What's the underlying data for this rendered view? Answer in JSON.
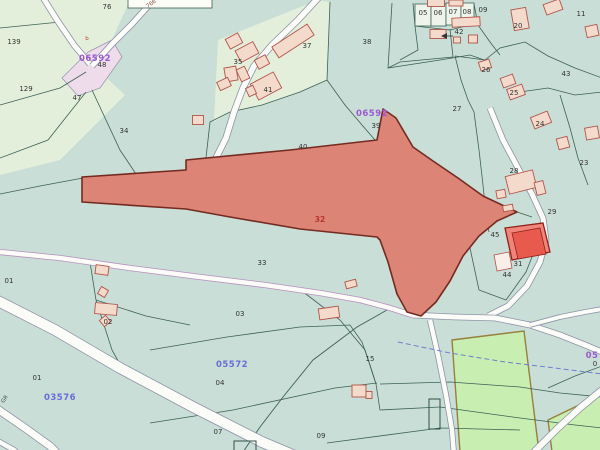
{
  "map_label": "cadastral-parcel-map",
  "colors": {
    "bg": "#c9ded6",
    "light": "#e4efdb",
    "line": "#3c6156",
    "road_fill": "#fbfbf7",
    "road_casing": "#8e93a8",
    "road_casing_purple": "#b88fc0",
    "junction_fill": "#eedceb",
    "field_fill": "#c9eeb2",
    "field_stroke": "#97803d",
    "p32_fill": "#dc8577",
    "p32_stroke": "#752a21",
    "p32_label": "#b5342c",
    "p31_fill": "#f0857b",
    "p31_stroke": "#8f2018",
    "p31_bld": "#e85a4e",
    "bld_fill": "#f4dacb",
    "bld_stroke": "#b2544a",
    "white_bld_fill": "#f8efe9",
    "stream": "#6f7fd0",
    "box_fill": "#eef4ec",
    "white_parcel_fill": "#fdfdf8",
    "sheet_purple": "#9b59d0",
    "sheet_blue": "#6b6bd8"
  },
  "light_areas": [
    [
      0,
      0,
      130,
      0,
      98,
      70,
      125,
      95,
      60,
      160,
      0,
      175
    ],
    [
      218,
      40,
      318,
      0,
      330,
      2,
      327,
      80,
      300,
      92,
      262,
      105,
      230,
      112,
      214,
      122
    ]
  ],
  "junction": [
    62,
    78,
    88,
    52,
    112,
    40,
    122,
    57,
    100,
    88,
    78,
    96
  ],
  "fields": [
    [
      452,
      340,
      524,
      331,
      539,
      452,
      460,
      452
    ],
    [
      548,
      420,
      602,
      394,
      602,
      452,
      552,
      452
    ]
  ],
  "white_parcel": [
    128,
    -5,
    84,
    13
  ],
  "boxes": [
    [
      415,
      4,
      16,
      22
    ],
    [
      431,
      4,
      15,
      22
    ],
    [
      446,
      3,
      15,
      22
    ],
    [
      461,
      3,
      13,
      22
    ]
  ],
  "dark_rects": [
    [
      429,
      399,
      11,
      30
    ],
    [
      234,
      441,
      22,
      12
    ]
  ],
  "boundaries": [
    [
      0,
      28,
      60,
      22,
      86,
      60
    ],
    [
      0,
      105,
      60,
      88,
      86,
      72
    ],
    [
      0,
      158,
      48,
      140,
      86,
      92
    ],
    [
      92,
      90,
      120,
      150,
      148,
      192
    ],
    [
      83,
      178,
      40,
      186,
      0,
      194
    ],
    [
      205,
      168,
      186,
      171
    ],
    [
      330,
      2,
      327,
      80
    ],
    [
      327,
      80,
      300,
      92,
      262,
      105,
      230,
      112,
      210,
      122,
      205,
      167
    ],
    [
      392,
      3,
      388,
      68,
      440,
      60,
      470,
      55,
      490,
      62
    ],
    [
      327,
      80,
      345,
      105,
      362,
      125,
      375,
      140
    ],
    [
      455,
      56,
      485,
      60,
      500,
      48,
      525,
      42,
      548,
      56,
      575,
      68,
      602,
      78
    ],
    [
      455,
      56,
      461,
      80,
      468,
      100,
      474,
      112
    ],
    [
      474,
      112,
      479,
      150,
      483,
      185,
      486,
      215,
      489,
      232
    ],
    [
      560,
      95,
      570,
      128,
      578,
      158,
      588,
      185
    ],
    [
      520,
      92,
      548,
      88,
      575,
      95,
      602,
      92
    ],
    [
      474,
      4,
      478,
      25,
      490,
      42,
      500,
      55
    ],
    [
      415,
      26,
      450,
      30,
      474,
      24
    ],
    [
      413,
      3,
      415,
      26,
      418,
      50,
      400,
      60
    ],
    [
      450,
      29,
      453,
      57,
      400,
      62,
      388,
      68
    ],
    [
      90,
      262,
      96,
      300,
      112,
      350,
      122,
      368
    ],
    [
      96,
      300,
      146,
      316,
      190,
      325
    ],
    [
      302,
      291,
      340,
      320,
      365,
      350,
      376,
      384
    ],
    [
      150,
      350,
      227,
      337,
      300,
      327,
      350,
      325,
      362,
      342,
      370,
      365,
      376,
      384
    ],
    [
      150,
      423,
      233,
      410,
      335,
      388,
      377,
      383
    ],
    [
      376,
      384,
      380,
      410,
      440,
      407
    ],
    [
      380,
      384,
      450,
      382,
      520,
      387,
      560,
      393,
      602,
      397
    ],
    [
      440,
      407,
      520,
      418,
      575,
      425,
      602,
      428
    ],
    [
      327,
      443,
      440,
      428,
      520,
      430
    ],
    [
      470,
      248,
      479,
      290,
      506,
      300
    ],
    [
      506,
      300,
      526,
      272,
      534,
      252
    ],
    [
      517,
      212,
      532,
      217
    ],
    [
      548,
      388,
      575,
      376,
      602,
      366
    ]
  ],
  "track": [
    387,
    310,
    357,
    327,
    313,
    360,
    283,
    397,
    260,
    427,
    243,
    452
  ],
  "roads": [
    {
      "pts": [
        42,
        -4,
        57,
        20,
        74,
        45,
        90,
        64
      ],
      "w": 5,
      "c": "road_casing"
    },
    {
      "pts": [
        92,
        66,
        112,
        44,
        132,
        24,
        150,
        4,
        155,
        -3
      ],
      "w": 5,
      "c": "road_casing"
    },
    {
      "pts": [
        320,
        -4,
        298,
        20,
        272,
        45,
        254,
        66,
        243,
        88,
        234,
        112,
        226,
        138,
        214,
        162
      ],
      "w": 5.5,
      "c": "road_casing"
    },
    {
      "pts": [
        0,
        252,
        60,
        258,
        130,
        268,
        200,
        277,
        265,
        285,
        320,
        293,
        360,
        300,
        390,
        308,
        412,
        315
      ],
      "w": 4.5,
      "c": "road_casing_purple"
    },
    {
      "pts": [
        490,
        108,
        503,
        140,
        518,
        168,
        532,
        194,
        543,
        218,
        546,
        240,
        540,
        262,
        527,
        286,
        508,
        306,
        488,
        316
      ],
      "w": 5,
      "c": "road_casing"
    },
    {
      "pts": [
        412,
        315,
        455,
        317,
        495,
        318,
        530,
        325,
        560,
        335,
        585,
        345,
        602,
        352
      ],
      "w": 5,
      "c": "road_casing"
    },
    {
      "pts": [
        530,
        325,
        560,
        317,
        585,
        312,
        602,
        309
      ],
      "w": 4,
      "c": "road_casing"
    },
    {
      "pts": [
        430,
        320,
        438,
        355,
        446,
        395,
        452,
        430,
        454,
        455
      ],
      "w": 4.5,
      "c": "road_casing"
    },
    {
      "pts": [
        -4,
        300,
        55,
        330,
        120,
        368,
        195,
        408,
        262,
        442,
        300,
        458
      ],
      "w": 10,
      "c": "road_casing"
    },
    {
      "pts": [
        -4,
        408,
        25,
        428,
        50,
        446,
        62,
        458
      ],
      "w": 7,
      "c": "road_casing"
    },
    {
      "pts": [
        -4,
        440,
        14,
        450,
        26,
        460
      ],
      "w": 4.5,
      "c": "road_casing"
    },
    {
      "pts": [
        530,
        456,
        558,
        428,
        580,
        408,
        602,
        390
      ],
      "w": 6,
      "c": "road_casing"
    }
  ],
  "stream": [
    398,
    342,
    450,
    353,
    505,
    362,
    555,
    368,
    602,
    374
  ],
  "parcel32": {
    "pts": [
      82,
      177,
      186,
      170,
      186,
      160,
      290,
      150,
      377,
      140,
      383,
      109,
      396,
      118,
      413,
      147,
      433,
      161,
      458,
      178,
      483,
      196,
      517,
      212,
      497,
      221,
      479,
      236,
      463,
      256,
      450,
      281,
      436,
      302,
      421,
      316,
      407,
      312,
      397,
      294,
      388,
      262,
      380,
      240,
      377,
      237,
      300,
      229,
      230,
      217,
      186,
      209,
      82,
      202
    ],
    "number": "32",
    "label_pos": [
      320,
      222
    ]
  },
  "parcel31": {
    "outer": [
      505,
      228,
      543,
      223,
      550,
      252,
      512,
      260
    ],
    "bld": [
      512,
      233,
      540,
      228,
      546,
      254,
      518,
      259
    ],
    "white_bld": [
      494,
      255,
      509,
      252,
      512,
      268,
      497,
      271
    ]
  },
  "buildings": [
    [
      293,
      41,
      42,
      13,
      -33
    ],
    [
      234,
      41,
      14,
      11,
      -28
    ],
    [
      247,
      52,
      20,
      13,
      -28
    ],
    [
      262,
      62,
      12,
      10,
      -28
    ],
    [
      231,
      74,
      12,
      14,
      -10
    ],
    [
      243,
      74,
      9,
      13,
      -25
    ],
    [
      224,
      84,
      12,
      9,
      -25
    ],
    [
      266,
      86,
      26,
      18,
      -28
    ],
    [
      251,
      91,
      8,
      9,
      -25
    ],
    [
      198,
      120,
      11,
      9,
      0
    ],
    [
      438,
      34,
      16,
      9,
      0
    ],
    [
      466,
      22,
      28,
      9,
      -3
    ],
    [
      473,
      39,
      9,
      8,
      0
    ],
    [
      457,
      40,
      7,
      6,
      0
    ],
    [
      436,
      3,
      17,
      7,
      0
    ],
    [
      456,
      3,
      14,
      6,
      0
    ],
    [
      520,
      19,
      15,
      21,
      -10
    ],
    [
      553,
      7,
      17,
      11,
      -20
    ],
    [
      592,
      31,
      12,
      11,
      -12
    ],
    [
      485,
      65,
      11,
      9,
      -18
    ],
    [
      508,
      81,
      13,
      10,
      -20
    ],
    [
      516,
      92,
      16,
      11,
      -20
    ],
    [
      541,
      120,
      18,
      12,
      -22
    ],
    [
      563,
      143,
      11,
      11,
      -15
    ],
    [
      592,
      133,
      13,
      12,
      -10
    ],
    [
      521,
      182,
      28,
      18,
      -14
    ],
    [
      540,
      188,
      9,
      13,
      -14
    ],
    [
      501,
      194,
      9,
      8,
      -10
    ],
    [
      508,
      208,
      10,
      6,
      -10
    ],
    [
      106,
      309,
      22,
      11,
      5
    ],
    [
      103,
      292,
      8,
      8,
      30
    ],
    [
      105,
      321,
      8,
      8,
      -40
    ],
    [
      102,
      270,
      13,
      9,
      8
    ],
    [
      329,
      313,
      20,
      11,
      -8
    ],
    [
      351,
      284,
      11,
      7,
      -15
    ],
    [
      359,
      391,
      14,
      12,
      0
    ],
    [
      369,
      395,
      6,
      7,
      0
    ]
  ],
  "arrow42": {
    "tri": [
      441,
      36,
      447,
      33,
      447,
      39
    ],
    "line": [
      447,
      36,
      453,
      36
    ]
  },
  "parcel_labels": [
    {
      "t": "76",
      "x": 107,
      "y": 9
    },
    {
      "t": "139",
      "x": 14,
      "y": 44
    },
    {
      "t": "129",
      "x": 26,
      "y": 91
    },
    {
      "t": "47",
      "x": 77,
      "y": 100
    },
    {
      "t": "34",
      "x": 124,
      "y": 133
    },
    {
      "t": "48",
      "x": 102,
      "y": 67
    },
    {
      "t": "37",
      "x": 307,
      "y": 48
    },
    {
      "t": "35",
      "x": 238,
      "y": 64
    },
    {
      "t": "41",
      "x": 268,
      "y": 92
    },
    {
      "t": "40",
      "x": 303,
      "y": 149
    },
    {
      "t": "38",
      "x": 367,
      "y": 44
    },
    {
      "t": "39",
      "x": 376,
      "y": 128
    },
    {
      "t": "42",
      "x": 459,
      "y": 34
    },
    {
      "t": "05",
      "x": 423,
      "y": 15
    },
    {
      "t": "06",
      "x": 438,
      "y": 15
    },
    {
      "t": "07",
      "x": 453,
      "y": 14
    },
    {
      "t": "08",
      "x": 467,
      "y": 14
    },
    {
      "t": "09",
      "x": 483,
      "y": 12
    },
    {
      "t": "20",
      "x": 518,
      "y": 28
    },
    {
      "t": "11",
      "x": 581,
      "y": 16
    },
    {
      "t": "43",
      "x": 566,
      "y": 76
    },
    {
      "t": "26",
      "x": 486,
      "y": 72
    },
    {
      "t": "25",
      "x": 514,
      "y": 95
    },
    {
      "t": "27",
      "x": 457,
      "y": 111
    },
    {
      "t": "24",
      "x": 540,
      "y": 126
    },
    {
      "t": "28",
      "x": 514,
      "y": 173
    },
    {
      "t": "23",
      "x": 584,
      "y": 165
    },
    {
      "t": "29",
      "x": 552,
      "y": 214
    },
    {
      "t": "45",
      "x": 495,
      "y": 237
    },
    {
      "t": "31",
      "x": 518,
      "y": 266
    },
    {
      "t": "44",
      "x": 507,
      "y": 277
    },
    {
      "t": "33",
      "x": 262,
      "y": 265
    },
    {
      "t": "01",
      "x": 9,
      "y": 283
    },
    {
      "t": "02",
      "x": 108,
      "y": 324
    },
    {
      "t": "03",
      "x": 240,
      "y": 316
    },
    {
      "t": "01",
      "x": 37,
      "y": 380
    },
    {
      "t": "04",
      "x": 220,
      "y": 385
    },
    {
      "t": "15",
      "x": 370,
      "y": 361
    },
    {
      "t": "07",
      "x": 218,
      "y": 434
    },
    {
      "t": "09",
      "x": 321,
      "y": 438
    },
    {
      "t": "0",
      "x": 595,
      "y": 366
    }
  ],
  "sheet_labels": [
    {
      "t": "06592",
      "x": 95,
      "y": 61,
      "c": "sheet_purple"
    },
    {
      "t": "06592",
      "x": 372,
      "y": 116,
      "c": "sheet_purple"
    },
    {
      "t": "05572",
      "x": 232,
      "y": 367,
      "c": "sheet_blue"
    },
    {
      "t": "03576",
      "x": 60,
      "y": 400,
      "c": "sheet_blue"
    },
    {
      "t": "05",
      "x": 592,
      "y": 358,
      "c": "sheet_purple"
    }
  ],
  "tiny_labels": [
    {
      "t": "766",
      "x": 152,
      "y": 5,
      "r": -35,
      "c": "#8b4a42"
    },
    {
      "t": "b",
      "x": 87,
      "y": 40,
      "r": 0,
      "c": "#c23b33"
    },
    {
      "t": "GR",
      "x": 6,
      "y": 400,
      "r": -55,
      "c": "#4a4a4a"
    }
  ]
}
